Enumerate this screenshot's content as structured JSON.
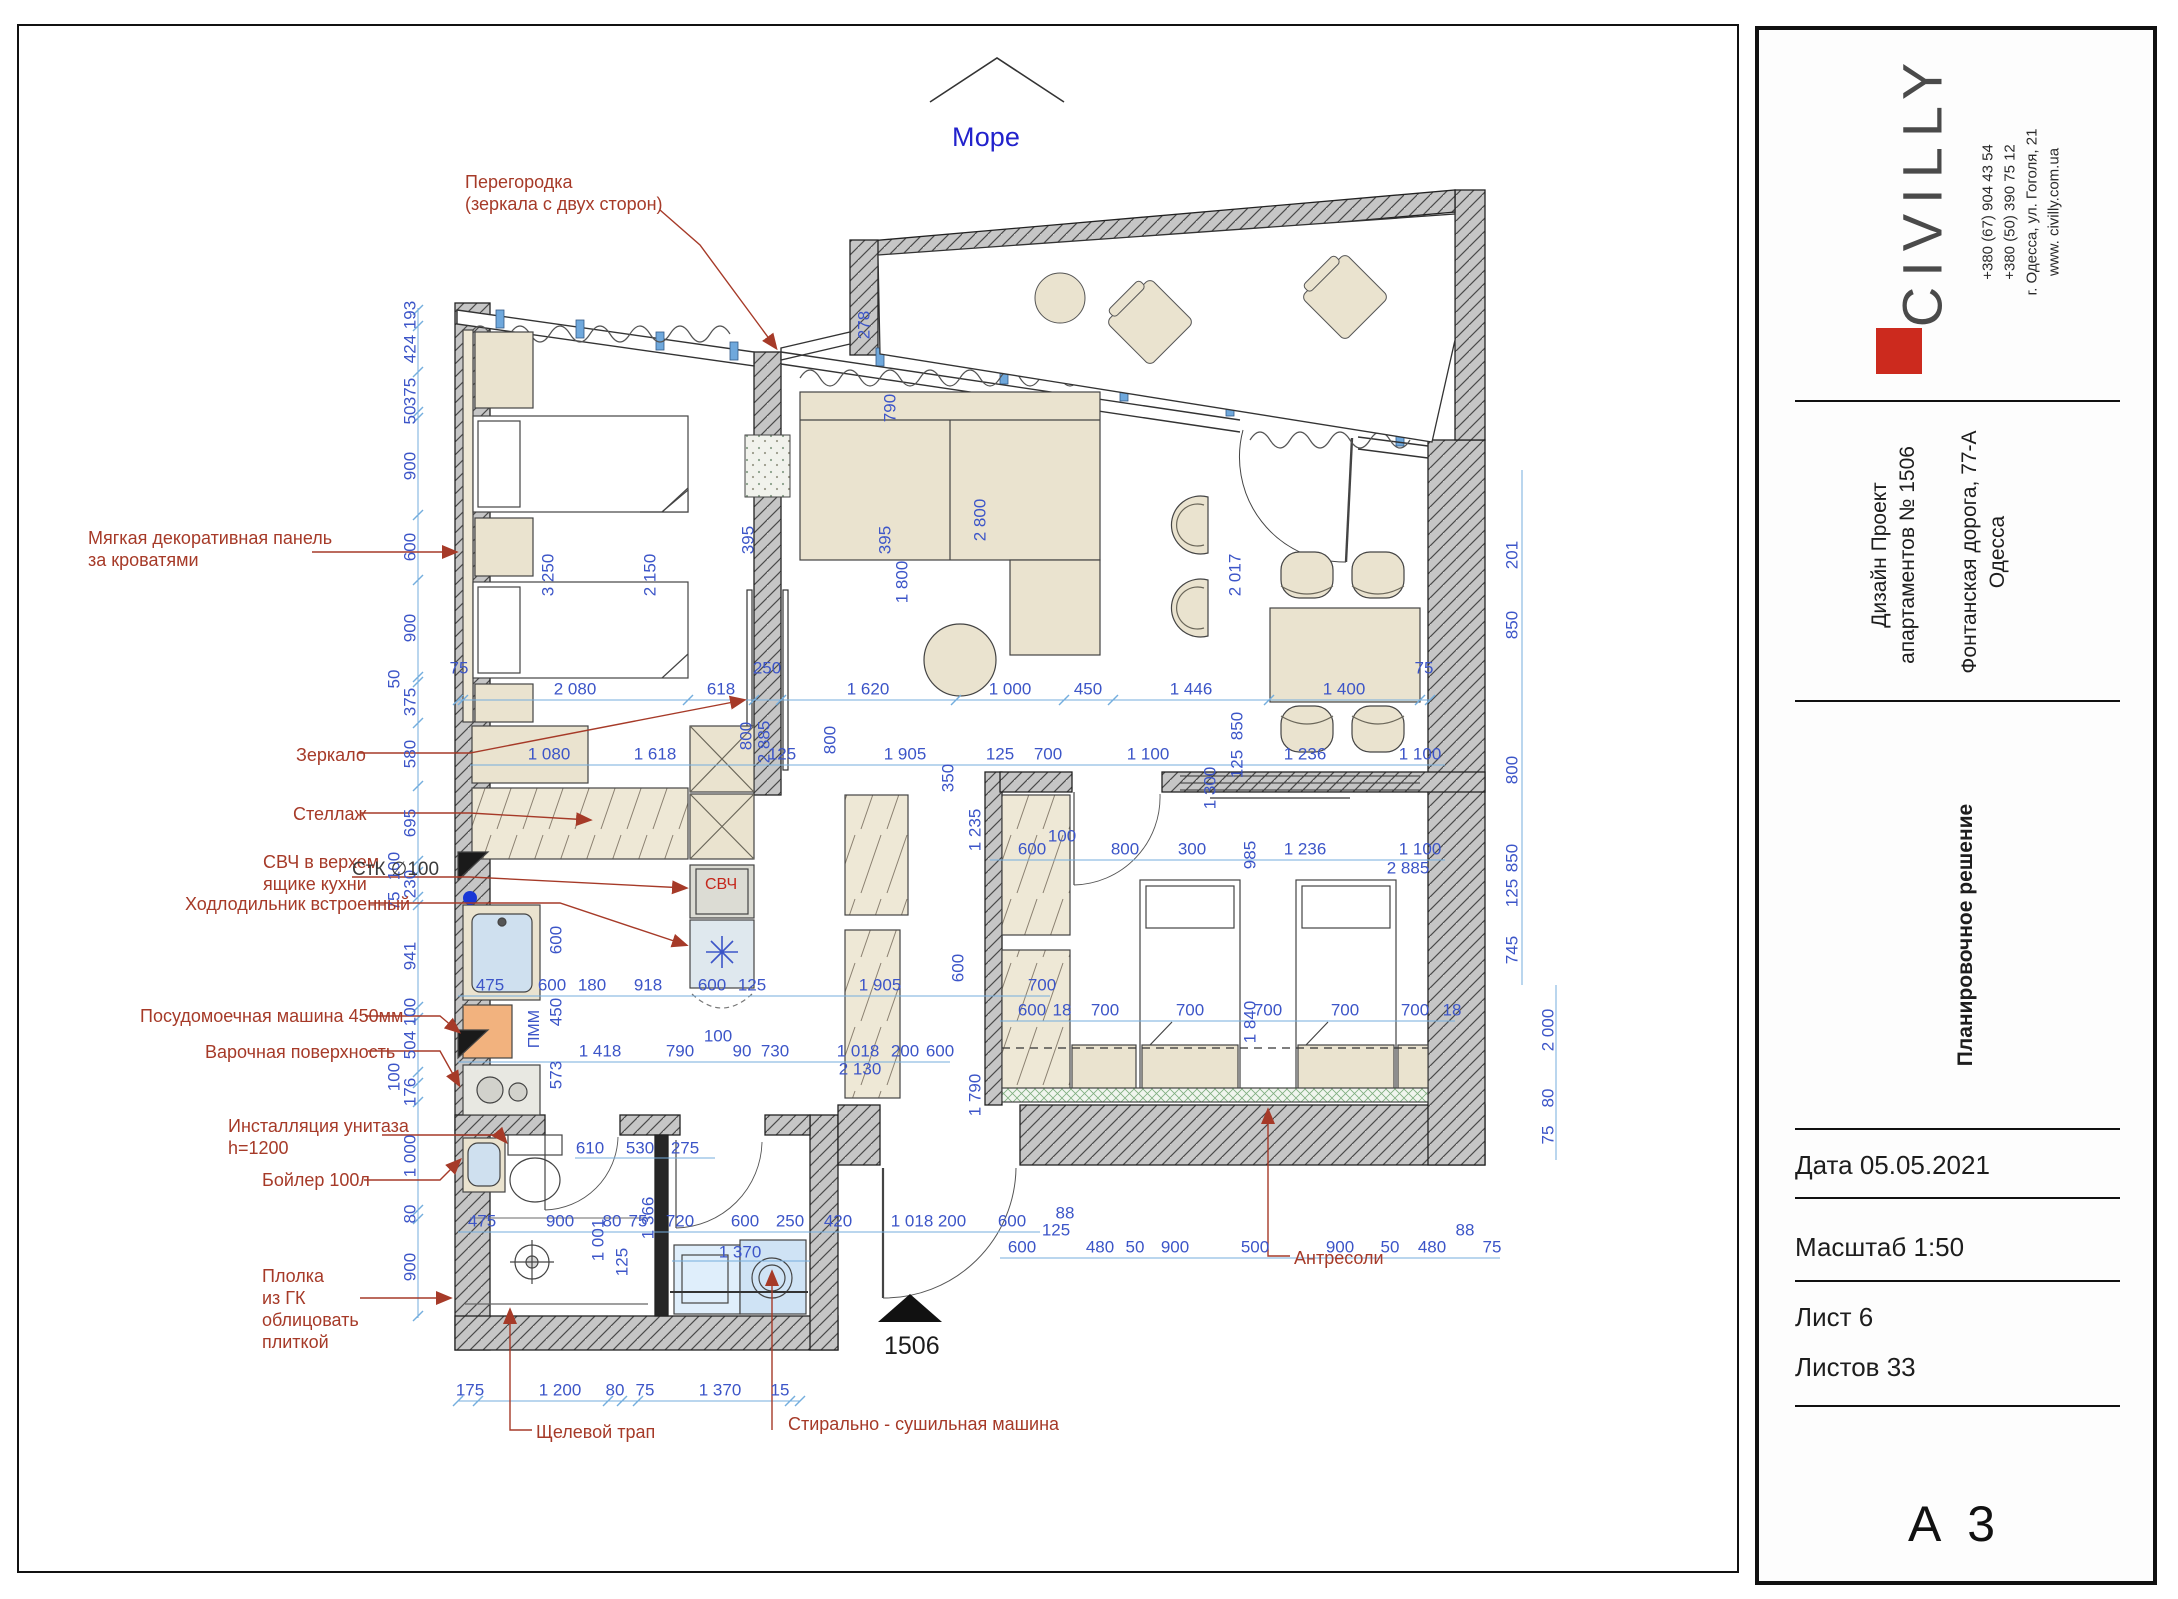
{
  "compass": {
    "label": "Море"
  },
  "entry_marker": {
    "label": "1506"
  },
  "plan_texts": [
    {
      "t": "Море",
      "x": 952,
      "y": 122,
      "cls": "more"
    },
    {
      "t": "1506",
      "x": 884,
      "y": 1332,
      "cls": "entry"
    },
    {
      "t": "СтК  ∅100",
      "x": 352,
      "y": 858,
      "cls": "stk"
    },
    {
      "t": "СВЧ",
      "x": 705,
      "y": 876,
      "cls": "svch"
    },
    {
      "t": "ПММ",
      "x": 516,
      "y": 1020,
      "cls": "pmm"
    }
  ],
  "annotations": [
    {
      "id": "partition",
      "x": 465,
      "y": 172,
      "lines": [
        "Перегородка",
        "(зеркала с двух сторон)"
      ]
    },
    {
      "id": "soft-panel",
      "x": 88,
      "y": 528,
      "lines": [
        "Мягкая декоративная панель",
        "за кроватями"
      ]
    },
    {
      "id": "mirror",
      "x": 296,
      "y": 745,
      "lines": [
        "Зеркало"
      ]
    },
    {
      "id": "shelving",
      "x": 293,
      "y": 804,
      "lines": [
        "Стеллаж"
      ]
    },
    {
      "id": "microwave",
      "x": 263,
      "y": 852,
      "lines": [
        "СВЧ в верхем",
        "ящике кухни"
      ]
    },
    {
      "id": "fridge",
      "x": 185,
      "y": 894,
      "lines": [
        "Ходлодильник встроенный"
      ]
    },
    {
      "id": "dishwasher",
      "x": 140,
      "y": 1006,
      "lines": [
        "Посудомоечная машина 450мм"
      ]
    },
    {
      "id": "cooktop",
      "x": 205,
      "y": 1042,
      "lines": [
        "Варочная поверхность"
      ]
    },
    {
      "id": "wc-frame",
      "x": 228,
      "y": 1116,
      "lines": [
        "Инсталляция унитаза",
        "h=1200"
      ]
    },
    {
      "id": "boiler",
      "x": 262,
      "y": 1170,
      "lines": [
        "Бойлер 100л"
      ]
    },
    {
      "id": "gk-shelf",
      "x": 262,
      "y": 1266,
      "lines": [
        "Плолка",
        "из ГК",
        "облицовать",
        "плиткой"
      ]
    },
    {
      "id": "antresoli",
      "x": 1294,
      "y": 1248,
      "lines": [
        "Антресоли"
      ]
    },
    {
      "id": "slot-drain",
      "x": 536,
      "y": 1422,
      "lines": [
        "Щелевой трап"
      ]
    },
    {
      "id": "washer-dryer",
      "x": 788,
      "y": 1414,
      "lines": [
        "Стирально - сушильная машина"
      ]
    }
  ],
  "dimensions": [
    {
      "t": "193",
      "x": 410,
      "y": 315,
      "r": 1
    },
    {
      "t": "424",
      "x": 410,
      "y": 349,
      "r": 1
    },
    {
      "t": "375",
      "x": 410,
      "y": 392,
      "r": 1
    },
    {
      "t": "50",
      "x": 410,
      "y": 415,
      "r": 1
    },
    {
      "t": "900",
      "x": 410,
      "y": 466,
      "r": 1
    },
    {
      "t": "600",
      "x": 410,
      "y": 547,
      "r": 1
    },
    {
      "t": "900",
      "x": 410,
      "y": 628,
      "r": 1
    },
    {
      "t": "50",
      "x": 394,
      "y": 679,
      "r": 1
    },
    {
      "t": "375",
      "x": 410,
      "y": 702,
      "r": 1
    },
    {
      "t": "580",
      "x": 410,
      "y": 754,
      "r": 1
    },
    {
      "t": "695",
      "x": 410,
      "y": 823,
      "r": 1
    },
    {
      "t": "100",
      "x": 394,
      "y": 866,
      "r": 1
    },
    {
      "t": "230",
      "x": 410,
      "y": 884,
      "r": 1
    },
    {
      "t": "75",
      "x": 394,
      "y": 901,
      "r": 1
    },
    {
      "t": "941",
      "x": 410,
      "y": 956,
      "r": 1
    },
    {
      "t": "100",
      "x": 410,
      "y": 1012,
      "r": 1
    },
    {
      "t": "504",
      "x": 410,
      "y": 1045,
      "r": 1
    },
    {
      "t": "100",
      "x": 394,
      "y": 1077,
      "r": 1
    },
    {
      "t": "176",
      "x": 410,
      "y": 1092,
      "r": 1
    },
    {
      "t": "1 000",
      "x": 410,
      "y": 1156,
      "r": 1
    },
    {
      "t": "80",
      "x": 410,
      "y": 1214,
      "r": 1
    },
    {
      "t": "900",
      "x": 410,
      "y": 1267,
      "r": 1
    },
    {
      "t": "75",
      "x": 459,
      "y": 668
    },
    {
      "t": "2 080",
      "x": 575,
      "y": 689
    },
    {
      "t": "618",
      "x": 721,
      "y": 689
    },
    {
      "t": "250",
      "x": 767,
      "y": 668
    },
    {
      "t": "1 620",
      "x": 868,
      "y": 689
    },
    {
      "t": "1 000",
      "x": 1010,
      "y": 689
    },
    {
      "t": "450",
      "x": 1088,
      "y": 689
    },
    {
      "t": "1 446",
      "x": 1191,
      "y": 689
    },
    {
      "t": "1 400",
      "x": 1344,
      "y": 689
    },
    {
      "t": "75",
      "x": 1424,
      "y": 668
    },
    {
      "t": "1 080",
      "x": 549,
      "y": 754
    },
    {
      "t": "1 618",
      "x": 655,
      "y": 754
    },
    {
      "t": "800",
      "x": 746,
      "y": 736,
      "r": 1
    },
    {
      "t": "2 885",
      "x": 764,
      "y": 742,
      "r": 1
    },
    {
      "t": "125",
      "x": 782,
      "y": 754
    },
    {
      "t": "800",
      "x": 830,
      "y": 740,
      "r": 1
    },
    {
      "t": "1 905",
      "x": 905,
      "y": 754
    },
    {
      "t": "125",
      "x": 1000,
      "y": 754
    },
    {
      "t": "700",
      "x": 1048,
      "y": 754
    },
    {
      "t": "1 100",
      "x": 1148,
      "y": 754
    },
    {
      "t": "1 236",
      "x": 1305,
      "y": 754
    },
    {
      "t": "1 100",
      "x": 1420,
      "y": 754
    },
    {
      "t": "600",
      "x": 1032,
      "y": 849
    },
    {
      "t": "100",
      "x": 1062,
      "y": 836
    },
    {
      "t": "800",
      "x": 1125,
      "y": 849
    },
    {
      "t": "300",
      "x": 1192,
      "y": 849
    },
    {
      "t": "1 236",
      "x": 1305,
      "y": 849
    },
    {
      "t": "1 100",
      "x": 1420,
      "y": 849
    },
    {
      "t": "2 885",
      "x": 1408,
      "y": 868
    },
    {
      "t": "600",
      "x": 1032,
      "y": 1010
    },
    {
      "t": "18",
      "x": 1062,
      "y": 1010
    },
    {
      "t": "700",
      "x": 1105,
      "y": 1010
    },
    {
      "t": "700",
      "x": 1190,
      "y": 1010
    },
    {
      "t": "700",
      "x": 1268,
      "y": 1010
    },
    {
      "t": "700",
      "x": 1345,
      "y": 1010
    },
    {
      "t": "700",
      "x": 1415,
      "y": 1010
    },
    {
      "t": "18",
      "x": 1452,
      "y": 1010
    },
    {
      "t": "3 250",
      "x": 548,
      "y": 575,
      "r": 1
    },
    {
      "t": "2 150",
      "x": 650,
      "y": 575,
      "r": 1
    },
    {
      "t": "1 800",
      "x": 902,
      "y": 582,
      "r": 1
    },
    {
      "t": "2 800",
      "x": 980,
      "y": 520,
      "r": 1
    },
    {
      "t": "395",
      "x": 748,
      "y": 540,
      "r": 1
    },
    {
      "t": "395",
      "x": 885,
      "y": 540,
      "r": 1
    },
    {
      "t": "790",
      "x": 890,
      "y": 408,
      "r": 1
    },
    {
      "t": "278",
      "x": 864,
      "y": 325,
      "r": 1
    },
    {
      "t": "350",
      "x": 948,
      "y": 778,
      "r": 1
    },
    {
      "t": "1 300",
      "x": 1210,
      "y": 788,
      "r": 1
    },
    {
      "t": "2 017",
      "x": 1235,
      "y": 575,
      "r": 1
    },
    {
      "t": "850",
      "x": 1237,
      "y": 726,
      "r": 1
    },
    {
      "t": "125",
      "x": 1237,
      "y": 764,
      "r": 1
    },
    {
      "t": "985",
      "x": 1250,
      "y": 855,
      "r": 1
    },
    {
      "t": "1 840",
      "x": 1250,
      "y": 1022,
      "r": 1
    },
    {
      "t": "1 235",
      "x": 975,
      "y": 830,
      "r": 1
    },
    {
      "t": "1 790",
      "x": 975,
      "y": 1095,
      "r": 1
    },
    {
      "t": "475",
      "x": 490,
      "y": 985
    },
    {
      "t": "600",
      "x": 552,
      "y": 985
    },
    {
      "t": "180",
      "x": 592,
      "y": 985
    },
    {
      "t": "918",
      "x": 648,
      "y": 985
    },
    {
      "t": "600",
      "x": 712,
      "y": 985
    },
    {
      "t": "125",
      "x": 752,
      "y": 985
    },
    {
      "t": "1 905",
      "x": 880,
      "y": 985
    },
    {
      "t": "600",
      "x": 958,
      "y": 968,
      "r": 1
    },
    {
      "t": "700",
      "x": 1042,
      "y": 985
    },
    {
      "t": "1 418",
      "x": 600,
      "y": 1051
    },
    {
      "t": "790",
      "x": 680,
      "y": 1051
    },
    {
      "t": "100",
      "x": 718,
      "y": 1036
    },
    {
      "t": "90",
      "x": 742,
      "y": 1051
    },
    {
      "t": "730",
      "x": 775,
      "y": 1051
    },
    {
      "t": "1 018",
      "x": 858,
      "y": 1051
    },
    {
      "t": "2 130",
      "x": 860,
      "y": 1069
    },
    {
      "t": "200",
      "x": 905,
      "y": 1051
    },
    {
      "t": "600",
      "x": 940,
      "y": 1051
    },
    {
      "t": "600",
      "x": 556,
      "y": 940,
      "r": 1
    },
    {
      "t": "450",
      "x": 556,
      "y": 1012,
      "r": 1
    },
    {
      "t": "573",
      "x": 556,
      "y": 1075,
      "r": 1
    },
    {
      "t": "610",
      "x": 590,
      "y": 1148
    },
    {
      "t": "530",
      "x": 640,
      "y": 1148
    },
    {
      "t": "275",
      "x": 685,
      "y": 1148
    },
    {
      "t": "1 001",
      "x": 598,
      "y": 1240,
      "r": 1
    },
    {
      "t": "1 366",
      "x": 648,
      "y": 1218,
      "r": 1
    },
    {
      "t": "125",
      "x": 622,
      "y": 1262,
      "r": 1
    },
    {
      "t": "475",
      "x": 482,
      "y": 1221
    },
    {
      "t": "900",
      "x": 560,
      "y": 1221
    },
    {
      "t": "80",
      "x": 612,
      "y": 1221
    },
    {
      "t": "75",
      "x": 638,
      "y": 1221
    },
    {
      "t": "720",
      "x": 680,
      "y": 1221
    },
    {
      "t": "600",
      "x": 745,
      "y": 1221
    },
    {
      "t": "250",
      "x": 790,
      "y": 1221
    },
    {
      "t": "420",
      "x": 838,
      "y": 1221
    },
    {
      "t": "1 018",
      "x": 912,
      "y": 1221
    },
    {
      "t": "200",
      "x": 952,
      "y": 1221
    },
    {
      "t": "600",
      "x": 1012,
      "y": 1221
    },
    {
      "t": "1 370",
      "x": 740,
      "y": 1252
    },
    {
      "t": "88",
      "x": 1065,
      "y": 1213
    },
    {
      "t": "125",
      "x": 1056,
      "y": 1230
    },
    {
      "t": "600",
      "x": 1022,
      "y": 1247
    },
    {
      "t": "480",
      "x": 1100,
      "y": 1247
    },
    {
      "t": "50",
      "x": 1135,
      "y": 1247
    },
    {
      "t": "900",
      "x": 1175,
      "y": 1247
    },
    {
      "t": "500",
      "x": 1255,
      "y": 1247
    },
    {
      "t": "900",
      "x": 1340,
      "y": 1247
    },
    {
      "t": "50",
      "x": 1390,
      "y": 1247
    },
    {
      "t": "480",
      "x": 1432,
      "y": 1247
    },
    {
      "t": "88",
      "x": 1465,
      "y": 1230
    },
    {
      "t": "75",
      "x": 1492,
      "y": 1247
    },
    {
      "t": "175",
      "x": 470,
      "y": 1390
    },
    {
      "t": "1 200",
      "x": 560,
      "y": 1390
    },
    {
      "t": "80",
      "x": 615,
      "y": 1390
    },
    {
      "t": "75",
      "x": 645,
      "y": 1390
    },
    {
      "t": "1 370",
      "x": 720,
      "y": 1390
    },
    {
      "t": "15",
      "x": 780,
      "y": 1390
    },
    {
      "t": "201",
      "x": 1512,
      "y": 555,
      "r": 1
    },
    {
      "t": "850",
      "x": 1512,
      "y": 625,
      "r": 1
    },
    {
      "t": "800",
      "x": 1512,
      "y": 770,
      "r": 1
    },
    {
      "t": "850",
      "x": 1512,
      "y": 858,
      "r": 1
    },
    {
      "t": "125",
      "x": 1512,
      "y": 893,
      "r": 1
    },
    {
      "t": "745",
      "x": 1512,
      "y": 950,
      "r": 1
    },
    {
      "t": "2 000",
      "x": 1548,
      "y": 1030,
      "r": 1
    },
    {
      "t": "80",
      "x": 1548,
      "y": 1098,
      "r": 1
    },
    {
      "t": "75",
      "x": 1548,
      "y": 1135,
      "r": 1
    }
  ],
  "titleblock": {
    "logo": "CIVILLY",
    "contact_lines": [
      "+380 (67) 904 43 54",
      "+380 (50) 390 75 12",
      "г. Одесса, ул. Гоголя, 21",
      "www. civilly.com.ua"
    ],
    "project_line1": "Дизайн Проект",
    "project_line2": "апартаментов № 1506",
    "address_line1": "Фонтанская дорога, 77-А",
    "address_line2": "Одесса",
    "doc_title": "Планировочное решение",
    "rows": [
      {
        "label": "Дата",
        "value": "05.05.2021"
      },
      {
        "label": "Масштаб",
        "value": "1:50"
      },
      {
        "label": "Лист",
        "value": "6"
      },
      {
        "label": "Листов",
        "value": "33"
      }
    ],
    "format": "А 3",
    "brand_color": "#cc2a1e"
  }
}
